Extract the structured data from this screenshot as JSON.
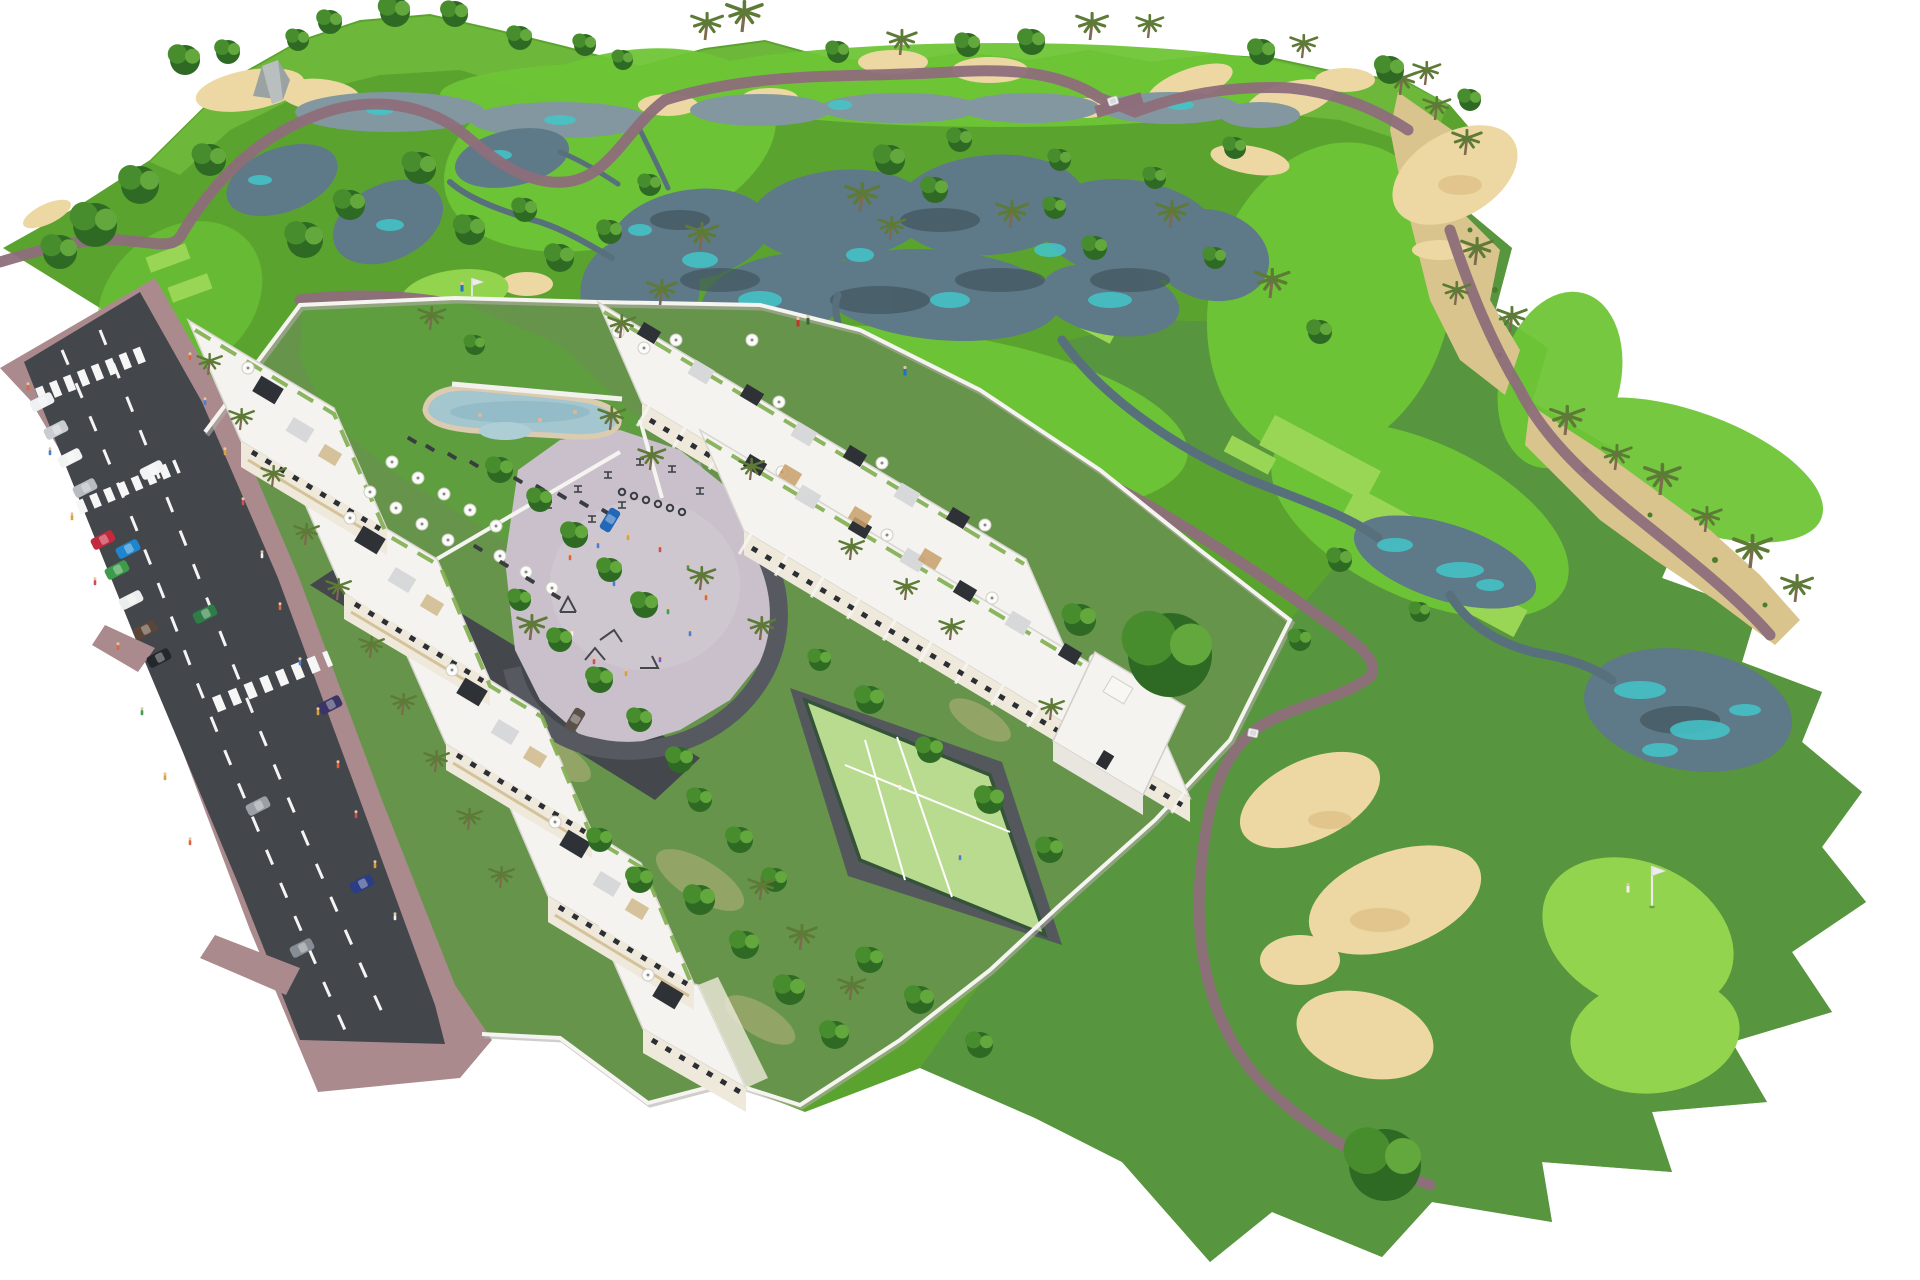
{
  "scene": {
    "kind": "aerial-3d-masterplan-rendering",
    "subject": "residential apartment and townhouse development beside a golf course",
    "background": "#ffffff"
  },
  "colors": {
    "bg": "#ffffff",
    "rough": "#5ba32f",
    "rough_right": "#579340",
    "horizon_band": "#7cc944",
    "fairway": "#6ec636",
    "green_bright": "#93d44f",
    "tee": "#9ad655",
    "lawn_garden": "#66944a",
    "lawn_pool": "#5f9e3f",
    "lake": "#5e7988",
    "lake_top": "#8297a0",
    "lake_teal": "#43c6c9",
    "lake_dark": "#41565f",
    "stream": "#57707c",
    "sand": "#edd8a3",
    "sand_scrub": "#d8c48c",
    "path": "#8e6e7b",
    "road_asphalt": "#43464b",
    "sidewalk": "#ab8a8e",
    "lane_marking": "#f4f4f4",
    "building_white": "#f4f3ef",
    "building_shade": "#e9e6df",
    "facade_cream": "#efe9dc",
    "wood": "#c8a06a",
    "beige_band": "#d5c29a",
    "window_dark": "#2b2e33",
    "pergola_dark": "#2e3237",
    "roof_gravel": "#d7d8da",
    "planter_green": "#7fae4e",
    "wall_white": "#f5f4f1",
    "pool_water": "#a3c6cf",
    "pool_deck": "#dbcbb0",
    "plaza": "#c9c0cb",
    "plaza_ring": "#565a60",
    "padel_surface": "#b9db8f",
    "padel_fence": "#35523a",
    "drive_asphalt": "#44474c",
    "tree_dark": "#2f6a24",
    "tree_mid": "#478d2d",
    "tree_light": "#63a83c",
    "palm_frond": "#5d7a36",
    "trunk": "#7d6a4f",
    "cart_white": "#f2f2f2",
    "flag_white": "#ececec",
    "rock_gray": "#9aa3a2"
  },
  "golf_course": {
    "fairway_count": 7,
    "green_count": 3,
    "tee_box_count": 9,
    "lake_count": 7,
    "stream_count": 5,
    "bunker_count": 17,
    "has_cart_paths": true,
    "has_bridge": true,
    "golf_cart_count": 2,
    "flag_count": 2,
    "golfers": [
      {
        "location": "practice-green-west",
        "shirt": "#1f6fd4"
      },
      {
        "location": "tee-box-north-1",
        "shirt": "#c4342f"
      },
      {
        "location": "tee-box-north-1",
        "shirt": "#2e6b34"
      },
      {
        "location": "tee-box-north-2",
        "shirt": "#1f6fd4"
      },
      {
        "location": "putting-green-east",
        "shirt": "#f0f0f0"
      }
    ]
  },
  "development": {
    "apartment_block": {
      "sections": 5,
      "floors_visible": 4,
      "rooftop_features": [
        "roof-terraces",
        "parasols",
        "dark-pergolas",
        "gravel-roofs",
        "green-planters"
      ]
    },
    "townhouses": {
      "rows": 2,
      "rooftop_features": [
        "solariums",
        "parasols",
        "awnings",
        "wood-pergolas"
      ]
    },
    "amenities": [
      "swimming-pool",
      "sun-lounger-terrace",
      "playground",
      "outdoor-gym",
      "padel-court",
      "bicycle-racks",
      "gated-driveway",
      "perimeter-walls"
    ],
    "pool": {
      "shape": "freeform",
      "parasol_count": 15,
      "lounger_count": 14
    },
    "padel_court": {
      "surface": "#b9db8f",
      "fence": "#35523a",
      "players": 2
    }
  },
  "road": {
    "lanes": 2,
    "lane_divider": "dashed-white",
    "crosswalk_count": 3,
    "parking": "parallel-bays",
    "pedestrian_count": 20,
    "parked_cars": [
      {
        "color": "#eef0f1"
      },
      {
        "color": "#c9cdd1"
      },
      {
        "color": "#f2f3f3"
      },
      {
        "color": "#b7bcc1"
      },
      {
        "color": "#c2293c"
      },
      {
        "color": "#3d9b4b"
      },
      {
        "color": "#eceded"
      },
      {
        "color": "#5a4638"
      },
      {
        "color": "#24272c"
      }
    ],
    "moving_cars": [
      {
        "color": "#f1f2f3"
      },
      {
        "color": "#1e86cf"
      },
      {
        "color": "#2e7d46"
      },
      {
        "color": "#9aa0a6"
      },
      {
        "color": "#878d94"
      },
      {
        "color": "#2b3d85"
      },
      {
        "color": "#3a3566"
      }
    ],
    "driveway_cars": [
      {
        "color": "#2268b8"
      },
      {
        "color": "#5a5148"
      }
    ]
  },
  "vegetation": {
    "round_tree_count": 58,
    "palm_tree_count": 44,
    "horizon_tree_row": true
  }
}
